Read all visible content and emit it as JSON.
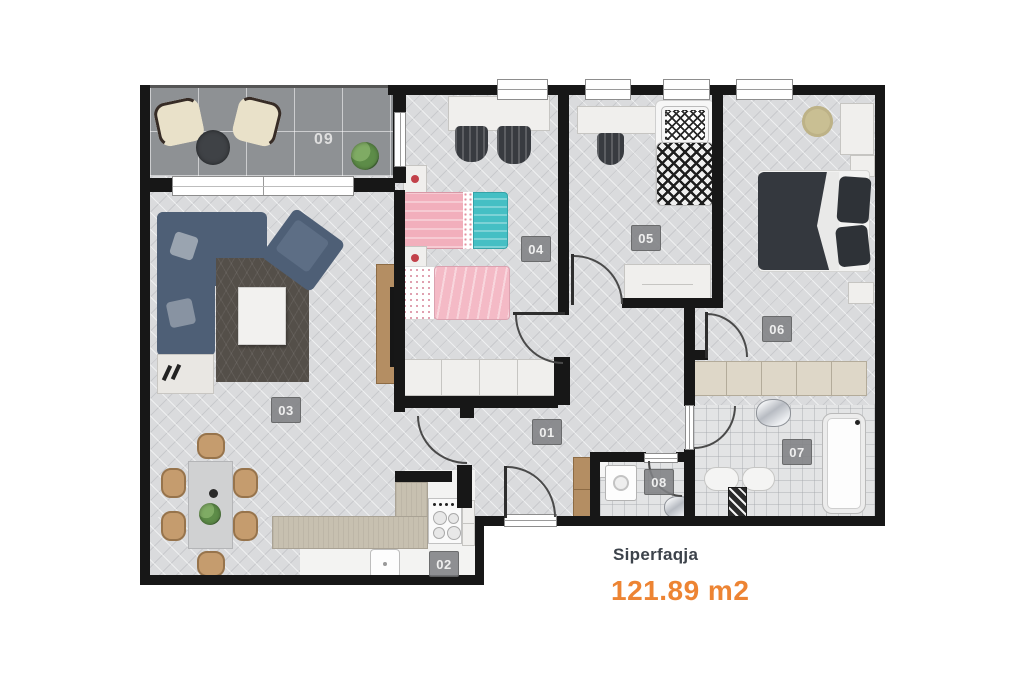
{
  "plan": {
    "title": "apartment-floor-plan",
    "rooms": [
      {
        "id": "01",
        "name": "hallway"
      },
      {
        "id": "02",
        "name": "kitchen"
      },
      {
        "id": "03",
        "name": "living-dining-room"
      },
      {
        "id": "04",
        "name": "kids-bedroom"
      },
      {
        "id": "05",
        "name": "bedroom"
      },
      {
        "id": "06",
        "name": "master-bedroom"
      },
      {
        "id": "07",
        "name": "bathroom"
      },
      {
        "id": "08",
        "name": "wc"
      },
      {
        "id": "09",
        "name": "balcony"
      }
    ]
  },
  "summary": {
    "label": "Siperfaqja",
    "value": "121.89 m2"
  },
  "colors": {
    "accent_orange": "#ED8433",
    "label_text": "#3d434b",
    "wall": "#171717",
    "floor": "#dadbdd",
    "balcony_tile": "#8e9194",
    "bath_tile": "#e3e4e5",
    "badge_bg": "#7f8184",
    "sofa_blue": "#4e5f76",
    "rug_brown": "#544f49",
    "bed_pink": "#f2afbc",
    "bed_teal": "#45bfc4",
    "duvet_dark": "#34383e",
    "counter_beige": "#c7c0b0",
    "wood": "#b48e63"
  }
}
